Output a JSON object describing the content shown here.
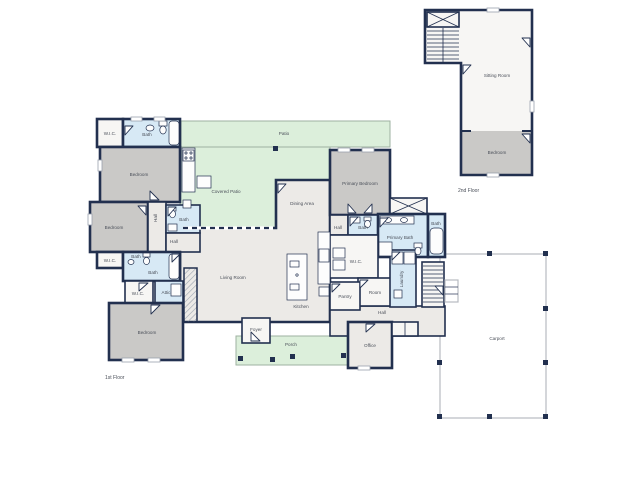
{
  "colors": {
    "wall": "#22304f",
    "bedroom": "#cac9c7",
    "bath": "#d7e9f5",
    "green": "#dcefdb",
    "neutral": "#eceae7",
    "white": "#f7f6f4",
    "carport": "#b7bac0",
    "text": "#4a4f59",
    "hatch": "#9aa2ae"
  },
  "first_floor": {
    "label": "1st Floor",
    "rooms": {
      "wic_a": "W.I.C.",
      "bath_a": "Bath",
      "bedroom_a": "Bedroom",
      "bedroom_b": "Bedroom",
      "hall_a": "Hall",
      "bath_b": "Bath",
      "hall_b": "Hall",
      "wic_b": "W.I.C.",
      "bath_c": "Bath",
      "bath_d": "Bath",
      "wic_c": "W.I.C.",
      "attic": "Attic",
      "bedroom_c": "Bedroom",
      "patio": "Patio",
      "covered_patio": "Covered Patio",
      "dining_area": "Dining Area",
      "living_room": "Living Room",
      "kitchen": "Kitchen",
      "pantry": "Pantry",
      "primary_bedroom": "Primary Bedroom",
      "hall_c": "Hall",
      "bath_e": "Bath",
      "primary_bath": "Primary Bath",
      "bath_f": "Bath",
      "wic_d": "W.I.C.",
      "room": "Room",
      "laundry": "Laundry",
      "hall_d": "Hall",
      "foyer": "Foyer",
      "porch": "Porch",
      "office": "Office",
      "carport": "Carport"
    }
  },
  "second_floor": {
    "label": "2nd Floor",
    "rooms": {
      "sitting_room": "Sitting Room",
      "bedroom": "Bedroom"
    }
  }
}
